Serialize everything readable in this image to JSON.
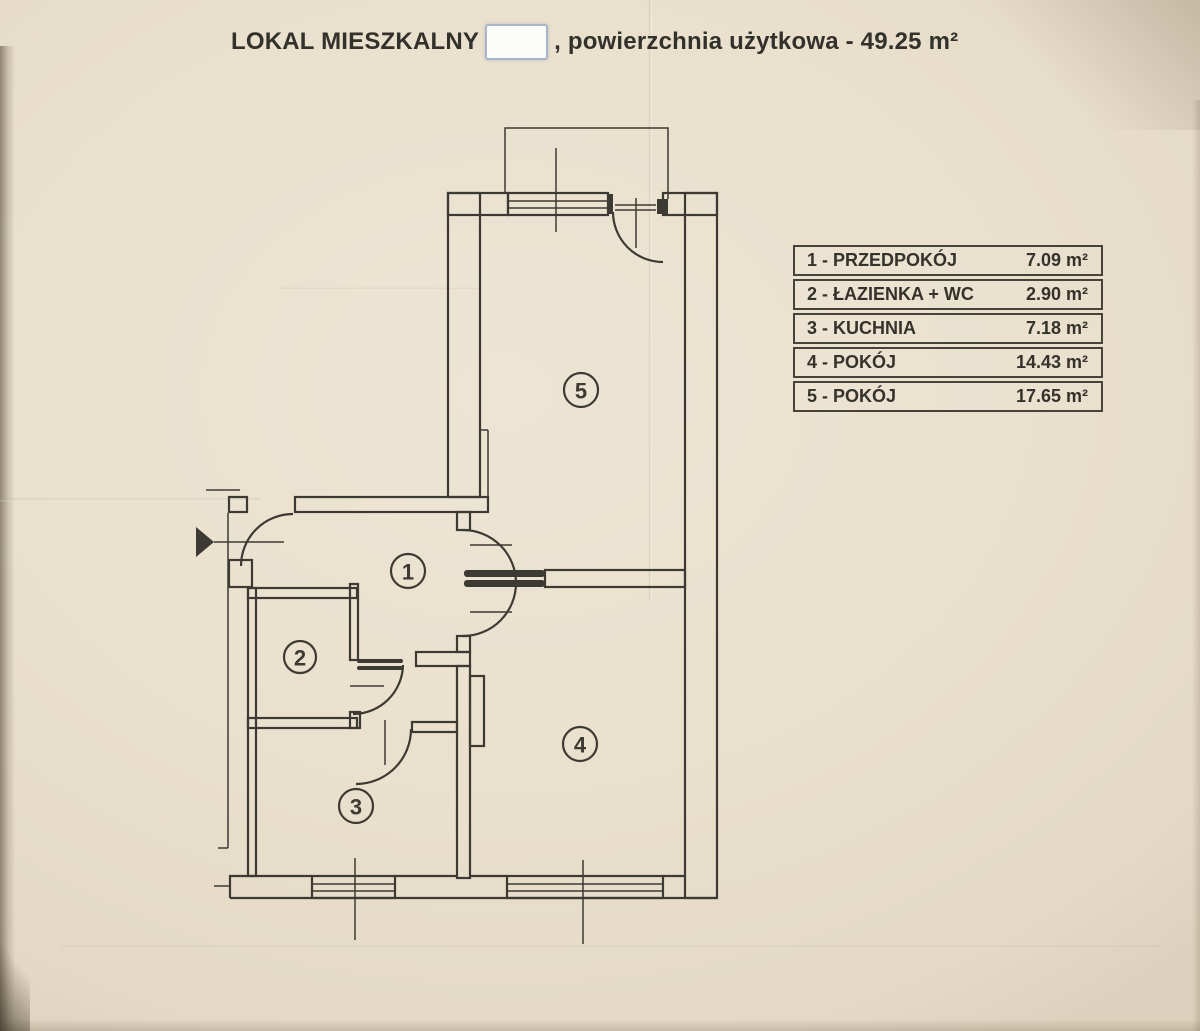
{
  "title": {
    "prefix": "LOKAL MIESZKALNY",
    "redacted_value": "",
    "suffix": ", powierzchnia użytkowa - 49.25 m²",
    "total_area": "49.25 m²"
  },
  "legend": {
    "rows": [
      {
        "label": "1 - PRZEDPOKÓJ",
        "area": "7.09 m²"
      },
      {
        "label": "2 - ŁAZIENKA + WC",
        "area": "2.90 m²"
      },
      {
        "label": "3 - KUCHNIA",
        "area": "7.18 m²"
      },
      {
        "label": "4 - POKÓJ",
        "area": "14.43 m²"
      },
      {
        "label": "5 - POKÓJ",
        "area": "17.65 m²"
      }
    ]
  },
  "plan": {
    "rooms": [
      {
        "number": "1",
        "name": "przedpokój"
      },
      {
        "number": "2",
        "name": "łazienka + wc"
      },
      {
        "number": "3",
        "name": "kuchnia"
      },
      {
        "number": "4",
        "name": "pokój"
      },
      {
        "number": "5",
        "name": "pokój"
      }
    ]
  },
  "colors": {
    "paper": "#e9e0cd",
    "ink": "#3c3a33",
    "redaction_border": "#a7b4ca"
  }
}
